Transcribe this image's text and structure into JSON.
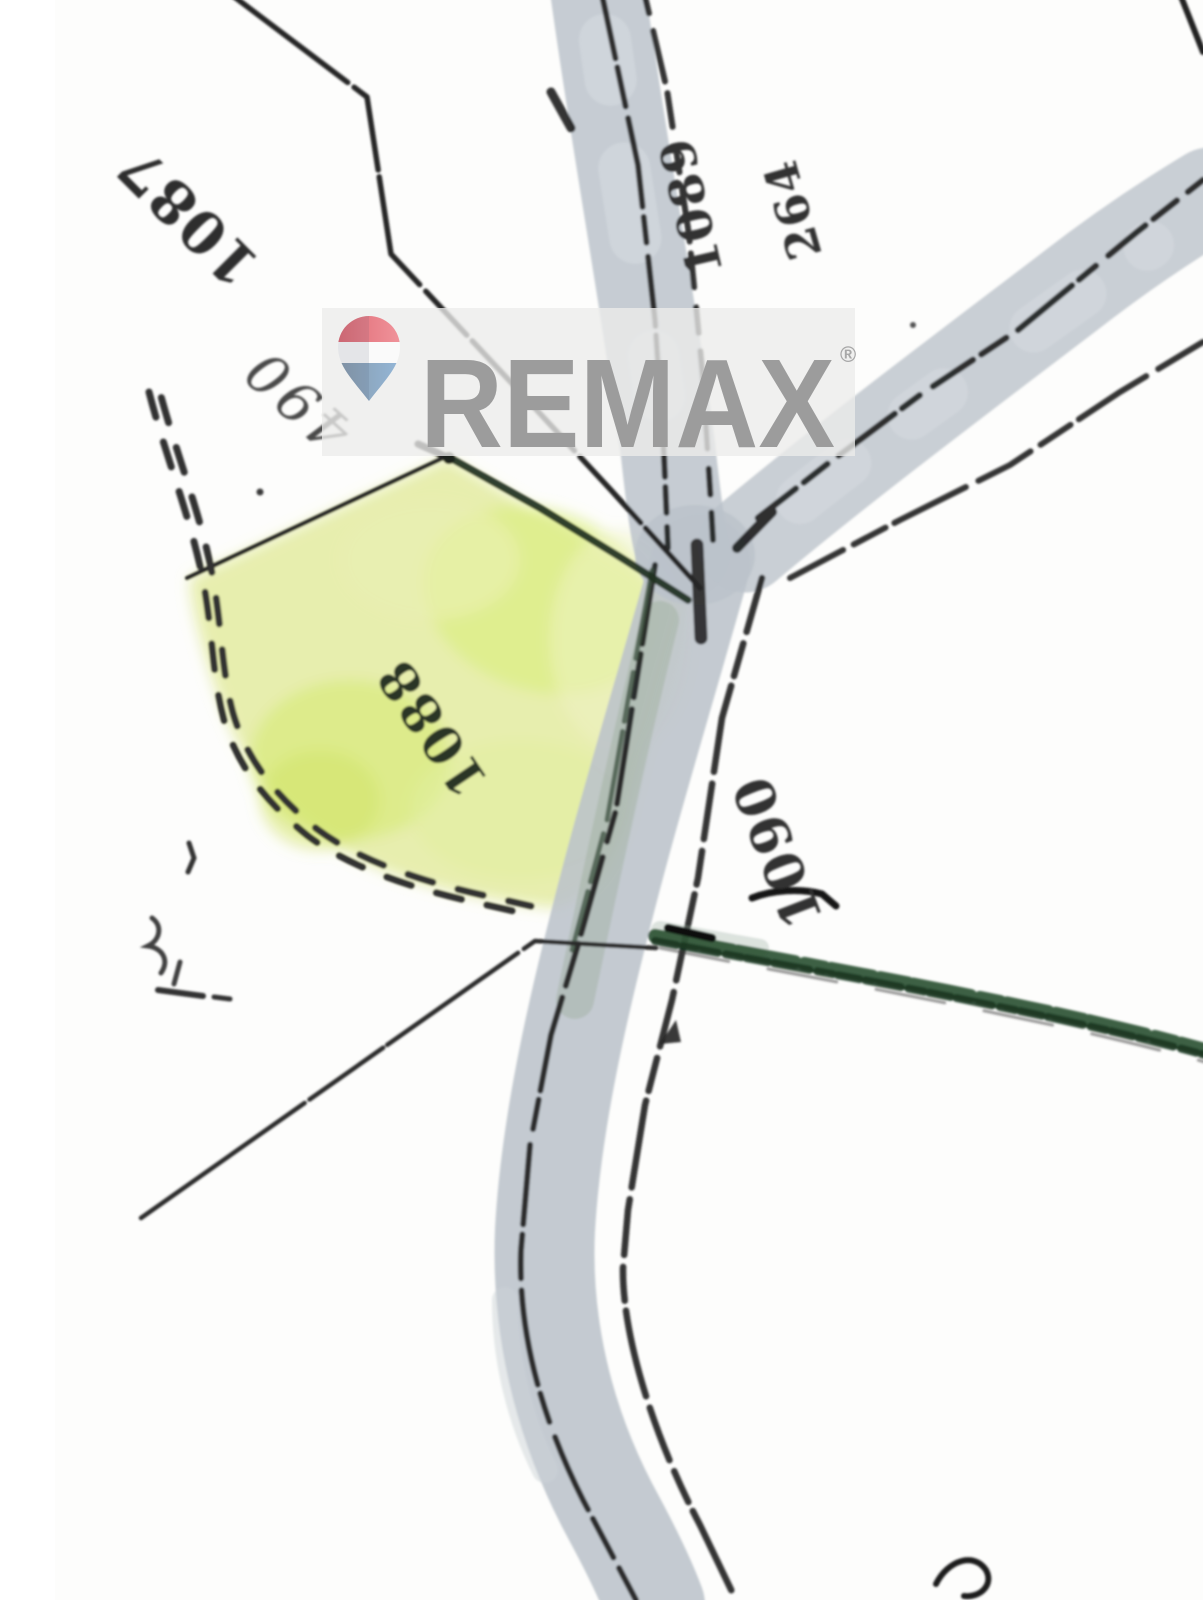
{
  "map": {
    "kind": "scanned hand-drawn cadastral sketch (rotated 180°)",
    "parcel_labels": [
      {
        "name": "1087"
      },
      {
        "name": "490"
      },
      {
        "name": "1089"
      },
      {
        "name": "264"
      },
      {
        "name": "1088",
        "highlighted": true
      },
      {
        "name": "1090"
      }
    ],
    "highlighted_parcel": "1088",
    "highlight_color": "#e6edaa",
    "road_color": "#bcc3cb",
    "hedge_color": "#2c5134",
    "line_color": "#262626"
  },
  "watermark": {
    "brand": "REMAX",
    "registered_mark": "®",
    "text_color": "#9c9c9c",
    "panel_color": "#ececea",
    "balloon": {
      "top_color": "#e8707a",
      "middle_color": "#fafafa",
      "bottom_color": "#8fb0d4"
    }
  }
}
